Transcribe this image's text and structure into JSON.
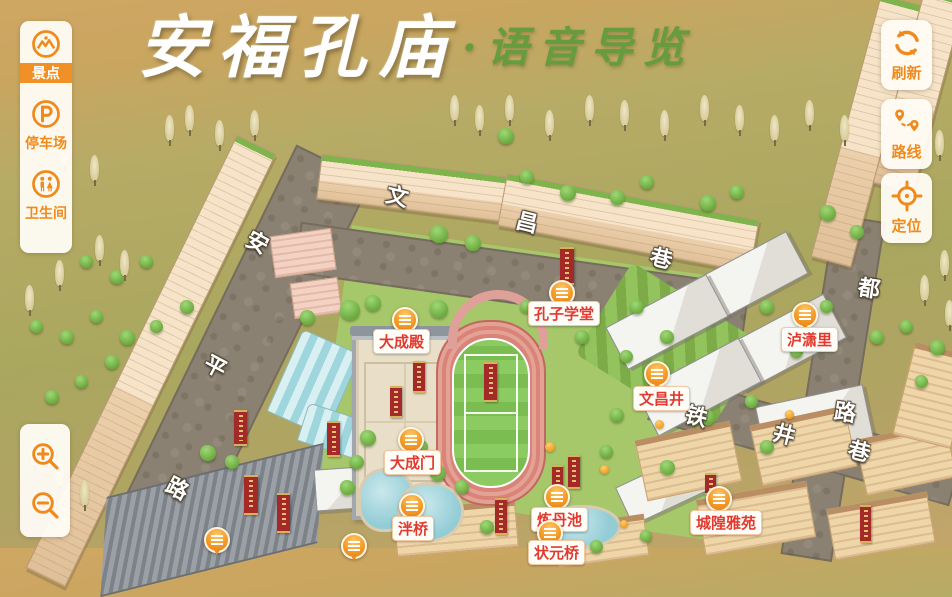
{
  "title": {
    "main": "安福孔庙",
    "sub": "·语音导览"
  },
  "colors": {
    "accent_orange": "#ef8b1d",
    "active_item_bg": "#f09026",
    "poi_label_red": "#e23a30",
    "title_green": "#679c3e",
    "panel_bg": "#fffcf5",
    "marker_orange": "#f29a28"
  },
  "left_toolbar": {
    "items": [
      {
        "id": "spots",
        "label": "景点",
        "icon": "scenic-spot-icon",
        "active": true
      },
      {
        "id": "parking",
        "label": "停车场",
        "icon": "parking-icon",
        "active": false
      },
      {
        "id": "toilet",
        "label": "卫生间",
        "icon": "restroom-icon",
        "active": false
      }
    ]
  },
  "right_toolbar": {
    "items": [
      {
        "id": "refresh",
        "label": "刷新",
        "icon": "refresh-icon"
      },
      {
        "id": "route",
        "label": "路线",
        "icon": "route-pins-icon"
      },
      {
        "id": "locate",
        "label": "定位",
        "icon": "locate-crosshair-icon"
      }
    ]
  },
  "zoom_controls": {
    "zoom_in_icon": "zoom-in-icon",
    "zoom_out_icon": "zoom-out-icon"
  },
  "map": {
    "marker_icon": "audio-lines-icon",
    "pois": [
      {
        "name": "大成殿",
        "marker": {
          "x": 403,
          "y": 318
        },
        "label": {
          "x": 373,
          "y": 329
        }
      },
      {
        "name": "孔子学堂",
        "marker": {
          "x": 560,
          "y": 291
        },
        "label": {
          "x": 528,
          "y": 301
        }
      },
      {
        "name": "泸潇里",
        "marker": {
          "x": 803,
          "y": 313
        },
        "label": {
          "x": 781,
          "y": 327
        }
      },
      {
        "name": "文昌井",
        "marker": {
          "x": 655,
          "y": 372
        },
        "label": {
          "x": 633,
          "y": 386
        }
      },
      {
        "name": "大成门",
        "marker": {
          "x": 409,
          "y": 438
        },
        "label": {
          "x": 384,
          "y": 450
        }
      },
      {
        "name": "泮桥",
        "marker": {
          "x": 410,
          "y": 504
        },
        "label": {
          "x": 392,
          "y": 516
        }
      },
      {
        "name": "炼丹池",
        "marker": {
          "x": 555,
          "y": 495
        },
        "label": {
          "x": 531,
          "y": 507
        }
      },
      {
        "name": "城隍雅苑",
        "marker": {
          "x": 717,
          "y": 497
        },
        "label": {
          "x": 690,
          "y": 510
        }
      },
      {
        "name": "状元桥",
        "marker": {
          "x": 548,
          "y": 531
        },
        "label": {
          "x": 528,
          "y": 540
        }
      }
    ],
    "extra_markers": [
      {
        "x": 215,
        "y": 538
      },
      {
        "x": 352,
        "y": 544
      }
    ],
    "streets": [
      {
        "name": "安平路",
        "chars": [
          {
            "ch": "安",
            "x": 246,
            "y": 232,
            "rot": 28
          },
          {
            "ch": "平",
            "x": 204,
            "y": 356,
            "rot": 28
          },
          {
            "ch": "路",
            "x": 166,
            "y": 478,
            "rot": 28
          }
        ]
      },
      {
        "name": "文昌巷",
        "chars": [
          {
            "ch": "文",
            "x": 386,
            "y": 186,
            "rot": 14
          },
          {
            "ch": "昌",
            "x": 516,
            "y": 212,
            "rot": 14
          },
          {
            "ch": "巷",
            "x": 650,
            "y": 248,
            "rot": 14
          }
        ]
      },
      {
        "name": "都路",
        "chars": [
          {
            "ch": "都",
            "x": 858,
            "y": 278,
            "rot": 8
          },
          {
            "ch": "路",
            "x": 834,
            "y": 402,
            "rot": 8
          }
        ]
      },
      {
        "name": "铁井巷",
        "chars": [
          {
            "ch": "铁",
            "x": 685,
            "y": 406,
            "rot": 14
          },
          {
            "ch": "井",
            "x": 773,
            "y": 424,
            "rot": 14
          },
          {
            "ch": "巷",
            "x": 848,
            "y": 441,
            "rot": 14
          }
        ]
      }
    ]
  }
}
